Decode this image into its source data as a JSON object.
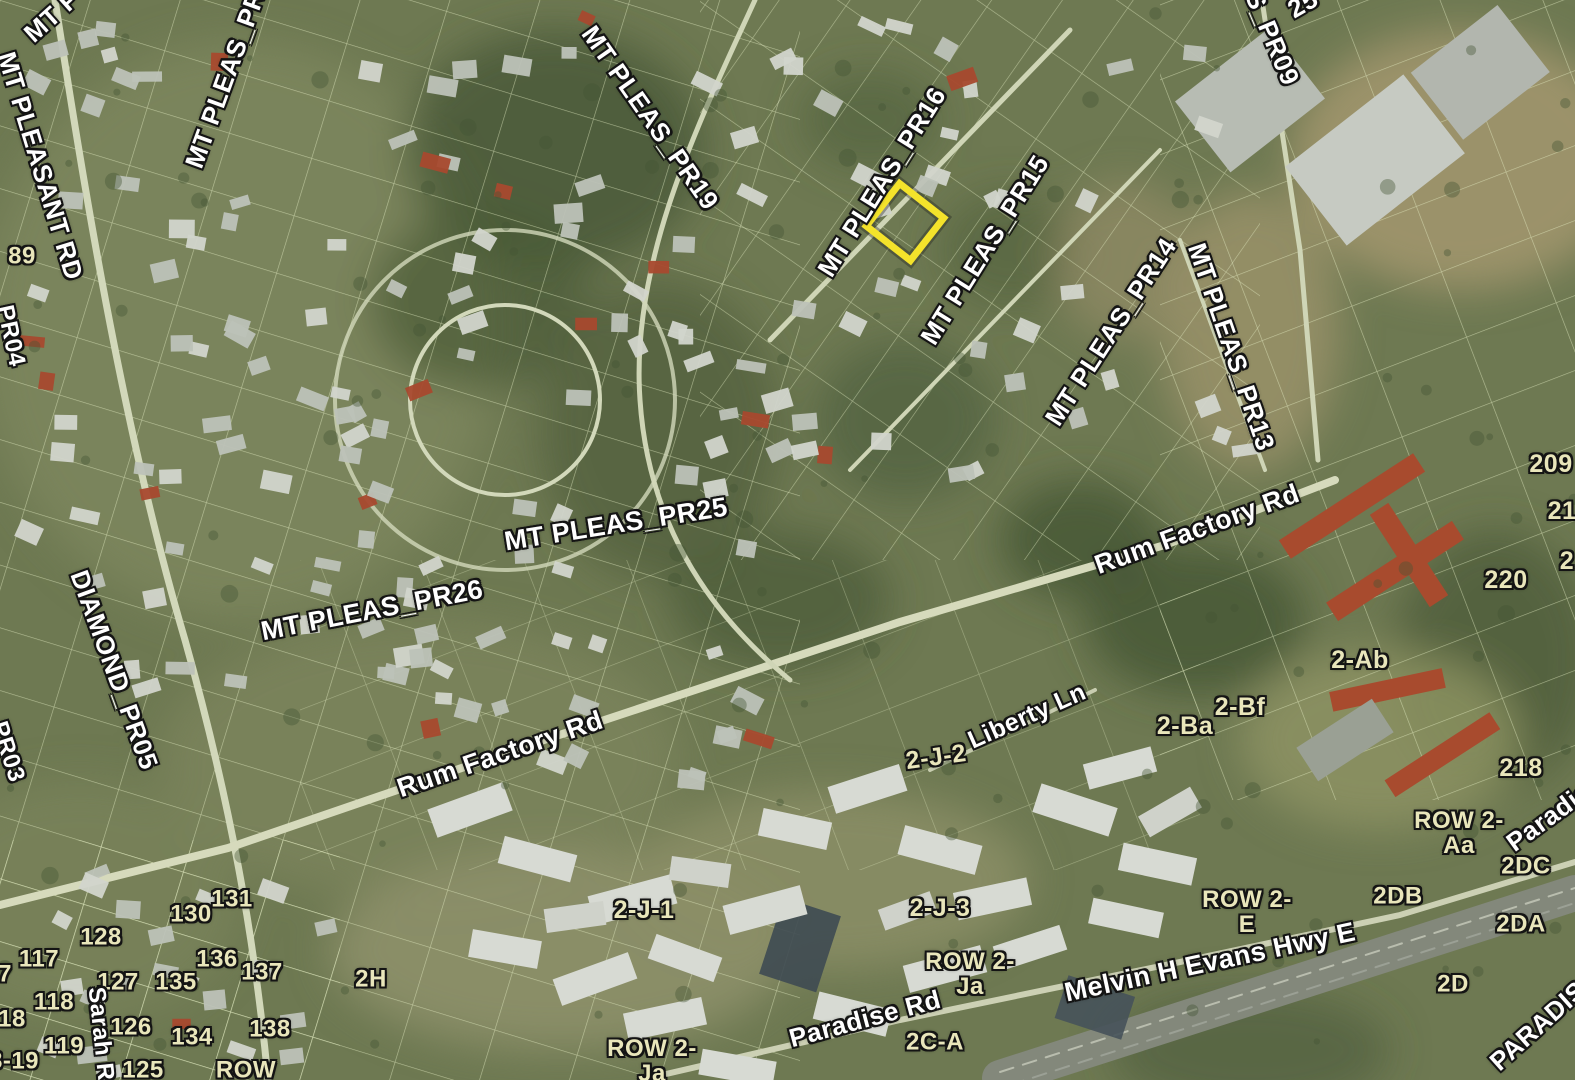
{
  "map": {
    "width": 1575,
    "height": 1080,
    "colors": {
      "ground": "#6e7952",
      "parcel_lines": "#e9f2c8",
      "road_label": "#ffffff",
      "parcel_label": "#e9e6bb",
      "highlight": "#f4e32b"
    },
    "highlight": {
      "name": "selected-parcel",
      "cx": 905,
      "cy": 222,
      "width": 54,
      "height": 56,
      "rotation": -52,
      "stroke_width": 7,
      "color": "#f4e32b"
    }
  },
  "labels": [
    {
      "text": "MT P",
      "x": 52,
      "y": 16,
      "rot": -42,
      "size": 26,
      "type": "road"
    },
    {
      "text": "MT PLEASANT RD",
      "x": 40,
      "y": 166,
      "rot": 73,
      "size": 26,
      "type": "road"
    },
    {
      "text": "MT PLEAS_PR2",
      "x": 228,
      "y": 72,
      "rot": -70,
      "size": 26,
      "type": "road"
    },
    {
      "text": "89",
      "x": 22,
      "y": 257,
      "rot": 0,
      "size": 24,
      "type": "parcel"
    },
    {
      "text": "PR04",
      "x": 10,
      "y": 336,
      "rot": 78,
      "size": 24,
      "type": "road"
    },
    {
      "text": "DIAMOND_PR05",
      "x": 114,
      "y": 670,
      "rot": 70,
      "size": 26,
      "type": "road"
    },
    {
      "text": "PR03",
      "x": 7,
      "y": 752,
      "rot": 72,
      "size": 24,
      "type": "road"
    },
    {
      "text": "MT PLEAS_PR19",
      "x": 650,
      "y": 118,
      "rot": 55,
      "size": 26,
      "type": "road"
    },
    {
      "text": "MT PLEAS_PR16",
      "x": 882,
      "y": 182,
      "rot": -58,
      "size": 26,
      "type": "road"
    },
    {
      "text": "MT PLEAS_PR15",
      "x": 985,
      "y": 250,
      "rot": -58,
      "size": 26,
      "type": "road"
    },
    {
      "text": "MT PLEAS_PR14",
      "x": 1111,
      "y": 332,
      "rot": -57,
      "size": 26,
      "type": "road"
    },
    {
      "text": "MT PLEAS_PR13",
      "x": 1231,
      "y": 347,
      "rot": 71,
      "size": 26,
      "type": "road"
    },
    {
      "text": "S_PR09",
      "x": 1272,
      "y": 38,
      "rot": 67,
      "size": 26,
      "type": "road"
    },
    {
      "text": "25",
      "x": 1303,
      "y": 4,
      "rot": -30,
      "size": 26,
      "type": "road"
    },
    {
      "text": "MT PLEAS_PR25",
      "x": 616,
      "y": 524,
      "rot": -9,
      "size": 27,
      "type": "road"
    },
    {
      "text": "MT PLEAS_PR26",
      "x": 372,
      "y": 610,
      "rot": -11,
      "size": 27,
      "type": "road"
    },
    {
      "text": "Rum Factory Rd",
      "x": 1197,
      "y": 529,
      "rot": -20,
      "size": 27,
      "type": "road"
    },
    {
      "text": "Rum Factory Rd",
      "x": 500,
      "y": 754,
      "rot": -19,
      "size": 27,
      "type": "road"
    },
    {
      "text": "209",
      "x": 1551,
      "y": 464,
      "rot": 0,
      "size": 25,
      "type": "parcel"
    },
    {
      "text": "21",
      "x": 1562,
      "y": 511,
      "rot": 0,
      "size": 25,
      "type": "parcel"
    },
    {
      "text": "2",
      "x": 1567,
      "y": 561,
      "rot": 0,
      "size": 25,
      "type": "parcel"
    },
    {
      "text": "220",
      "x": 1506,
      "y": 580,
      "rot": 0,
      "size": 25,
      "type": "parcel"
    },
    {
      "text": "2-Ab",
      "x": 1360,
      "y": 660,
      "rot": 0,
      "size": 25,
      "type": "parcel"
    },
    {
      "text": "2-Bf",
      "x": 1240,
      "y": 707,
      "rot": 0,
      "size": 25,
      "type": "parcel"
    },
    {
      "text": "2-Ba",
      "x": 1185,
      "y": 726,
      "rot": 0,
      "size": 25,
      "type": "parcel"
    },
    {
      "text": "218",
      "x": 1521,
      "y": 768,
      "rot": 0,
      "size": 25,
      "type": "parcel"
    },
    {
      "text": "Liberty Ln",
      "x": 1027,
      "y": 716,
      "rot": -24,
      "size": 25,
      "type": "road"
    },
    {
      "text": "2-J-2",
      "x": 936,
      "y": 757,
      "rot": -8,
      "size": 25,
      "type": "parcel"
    },
    {
      "text": "2-J-1",
      "x": 644,
      "y": 910,
      "rot": 0,
      "size": 25,
      "type": "parcel"
    },
    {
      "text": "2-J-3",
      "x": 940,
      "y": 908,
      "rot": 0,
      "size": 25,
      "type": "parcel"
    },
    {
      "lines": [
        "ROW 2-",
        "E"
      ],
      "x": 1247,
      "y": 913,
      "rot": 0,
      "size": 24,
      "type": "parcel"
    },
    {
      "text": "2DB",
      "x": 1398,
      "y": 897,
      "rot": 0,
      "size": 24,
      "type": "parcel"
    },
    {
      "text": "2DA",
      "x": 1521,
      "y": 925,
      "rot": 0,
      "size": 24,
      "type": "parcel"
    },
    {
      "text": "2DC",
      "x": 1526,
      "y": 867,
      "rot": 0,
      "size": 24,
      "type": "parcel"
    },
    {
      "lines": [
        "ROW 2-",
        "Aa"
      ],
      "x": 1459,
      "y": 834,
      "rot": 0,
      "size": 24,
      "type": "parcel"
    },
    {
      "text": "Paradis",
      "x": 1549,
      "y": 817,
      "rot": -36,
      "size": 26,
      "type": "road"
    },
    {
      "text": "Melvin H Evans Hwy E",
      "x": 1210,
      "y": 962,
      "rot": -12,
      "size": 27,
      "type": "road"
    },
    {
      "text": "2D",
      "x": 1453,
      "y": 985,
      "rot": 0,
      "size": 24,
      "type": "parcel"
    },
    {
      "text": "PARADIS",
      "x": 1538,
      "y": 1026,
      "rot": -42,
      "size": 26,
      "type": "road"
    },
    {
      "text": "Paradise Rd",
      "x": 865,
      "y": 1019,
      "rot": -15,
      "size": 26,
      "type": "road"
    },
    {
      "text": "2C-A",
      "x": 935,
      "y": 1043,
      "rot": 0,
      "size": 24,
      "type": "parcel"
    },
    {
      "lines": [
        "ROW 2-",
        "Ja"
      ],
      "x": 652,
      "y": 1062,
      "rot": 0,
      "size": 24,
      "type": "parcel"
    },
    {
      "lines": [
        "ROW 2-",
        "Ja"
      ],
      "x": 970,
      "y": 975,
      "rot": 0,
      "size": 24,
      "type": "parcel"
    },
    {
      "text": "2H",
      "x": 371,
      "y": 980,
      "rot": 0,
      "size": 24,
      "type": "parcel"
    },
    {
      "text": "131",
      "x": 232,
      "y": 900,
      "rot": 0,
      "size": 24,
      "type": "parcel"
    },
    {
      "text": "130",
      "x": 191,
      "y": 915,
      "rot": 0,
      "size": 24,
      "type": "parcel"
    },
    {
      "text": "128",
      "x": 101,
      "y": 938,
      "rot": 0,
      "size": 24,
      "type": "parcel"
    },
    {
      "text": "117",
      "x": 39,
      "y": 960,
      "rot": 0,
      "size": 24,
      "type": "parcel"
    },
    {
      "text": "7",
      "x": 5,
      "y": 975,
      "rot": 0,
      "size": 24,
      "type": "parcel"
    },
    {
      "text": "136",
      "x": 217,
      "y": 960,
      "rot": 0,
      "size": 24,
      "type": "parcel"
    },
    {
      "text": "137",
      "x": 262,
      "y": 973,
      "rot": 0,
      "size": 24,
      "type": "parcel"
    },
    {
      "text": "127",
      "x": 118,
      "y": 983,
      "rot": 0,
      "size": 24,
      "type": "parcel"
    },
    {
      "text": "135",
      "x": 176,
      "y": 983,
      "rot": 0,
      "size": 24,
      "type": "parcel"
    },
    {
      "text": "118",
      "x": 54,
      "y": 1003,
      "rot": 0,
      "size": 24,
      "type": "parcel"
    },
    {
      "text": "18",
      "x": 12,
      "y": 1020,
      "rot": 0,
      "size": 24,
      "type": "parcel"
    },
    {
      "text": "126",
      "x": 131,
      "y": 1028,
      "rot": 0,
      "size": 24,
      "type": "parcel"
    },
    {
      "text": "119",
      "x": 64,
      "y": 1047,
      "rot": 0,
      "size": 24,
      "type": "parcel"
    },
    {
      "text": "134",
      "x": 192,
      "y": 1038,
      "rot": 0,
      "size": 24,
      "type": "parcel"
    },
    {
      "text": "138",
      "x": 270,
      "y": 1030,
      "rot": 0,
      "size": 24,
      "type": "parcel"
    },
    {
      "text": "8-19",
      "x": 14,
      "y": 1062,
      "rot": 0,
      "size": 24,
      "type": "parcel"
    },
    {
      "text": "125",
      "x": 143,
      "y": 1071,
      "rot": 0,
      "size": 24,
      "type": "parcel"
    },
    {
      "text": "Sarah R",
      "x": 100,
      "y": 1034,
      "rot": 84,
      "size": 24,
      "type": "road"
    },
    {
      "text": "ROW",
      "x": 246,
      "y": 1071,
      "rot": 0,
      "size": 24,
      "type": "parcel"
    }
  ]
}
